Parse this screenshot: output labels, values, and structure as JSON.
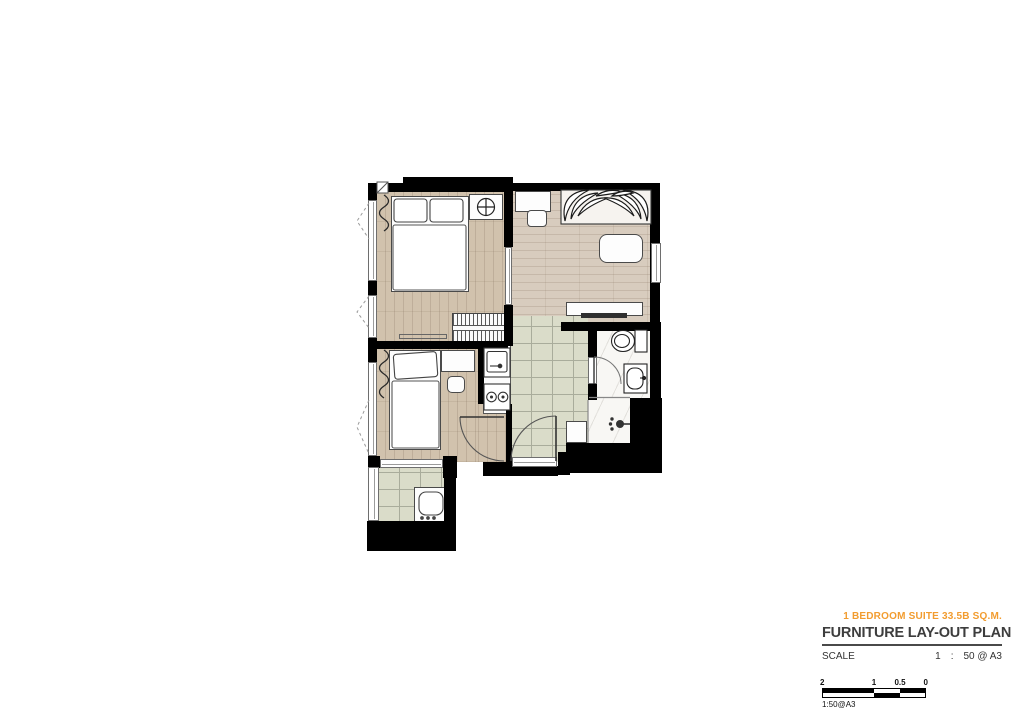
{
  "page": {
    "background": "#FFFFFF"
  },
  "title_block": {
    "unit_label": "1 BEDROOM SUITE 33.5B SQ.M.",
    "plan_title": "FURNITURE LAY-OUT PLAN",
    "scale_label": "SCALE",
    "scale_parts": {
      "numerator": "1",
      "separator": ":",
      "value": "50 @ A3"
    },
    "accent_color": "#F29C2F",
    "title_color": "#3D3D3D"
  },
  "scale_bar": {
    "ticks": [
      "2",
      "1",
      "0.5",
      "0"
    ],
    "caption": "1:50@A3"
  },
  "plan": {
    "colors": {
      "wall": "#000000",
      "wood_bedroom": "#D1C2AD",
      "wood_living": "#D8CCBE",
      "tile": "#DADCC9",
      "tile_grout": "#A9AC9B",
      "marble": "#F8F7F4",
      "furniture_outline": "#4A4A4A"
    },
    "rooms": [
      "master-bedroom",
      "living-room",
      "second-bedroom",
      "kitchen",
      "corridor",
      "bathroom",
      "shower",
      "balcony"
    ],
    "fixtures": [
      "double-bed",
      "pillows",
      "nightstand",
      "ceiling-light-symbol",
      "wardrobe-hanging-rail",
      "curtains",
      "sliding-door",
      "daybed-sofa",
      "leaf-decoration",
      "work-desk",
      "chair",
      "coffee-table",
      "tv-cabinet",
      "television",
      "kitchen-counter",
      "kitchen-sink",
      "two-burner-stove",
      "single-bed",
      "study-desk",
      "stool",
      "shoe-cabinet",
      "entrance-door",
      "toilet",
      "washbasin",
      "shower-head",
      "washing-machine",
      "windows",
      "door-swing-arcs"
    ]
  }
}
